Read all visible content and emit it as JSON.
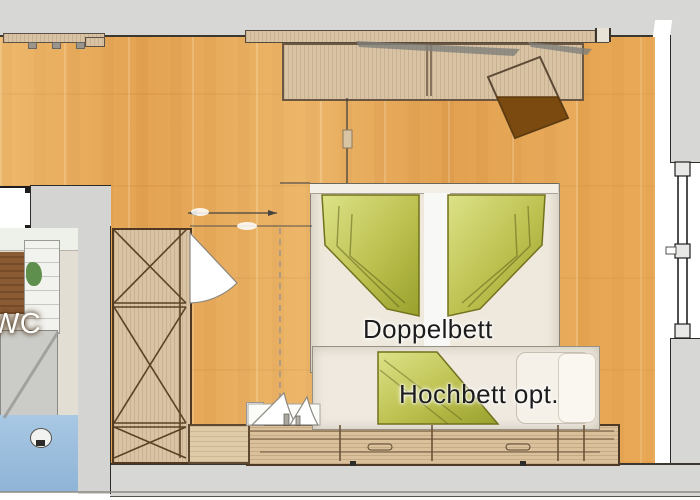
{
  "floorplan": {
    "type": "hotel-room floor plan",
    "room_labels": {
      "double_bed": "Doppelbett",
      "loft_bed": "Hochbett opt.",
      "wc": "WC"
    },
    "features": {
      "double_bed": "double bed with two green folded duvets",
      "loft_bed": "optional loft bed along foot of double bed",
      "wardrobe_top": "wardrobe against top wall",
      "closet_left": "tall cabinet with X-front panels",
      "entry_door": "door with quarter-circle swing next to cabinet",
      "window_right": "window in right exterior wall",
      "stool": "tilted brown square stool near wardrobe",
      "bench_bottom": "low wooden sideboard along bottom wall",
      "wc_room": "small WC room in lower left corner"
    },
    "colors": {
      "floor_wood": "#e7aa58",
      "wall_gray": "#d7d7d5",
      "furniture_wood": "#d8c3a4",
      "duvet_green": "#bcc04e",
      "stool_brown": "#7a4a10",
      "wc_floor_blue": "#9cc0de",
      "label_text": "#1c1c1c"
    }
  }
}
